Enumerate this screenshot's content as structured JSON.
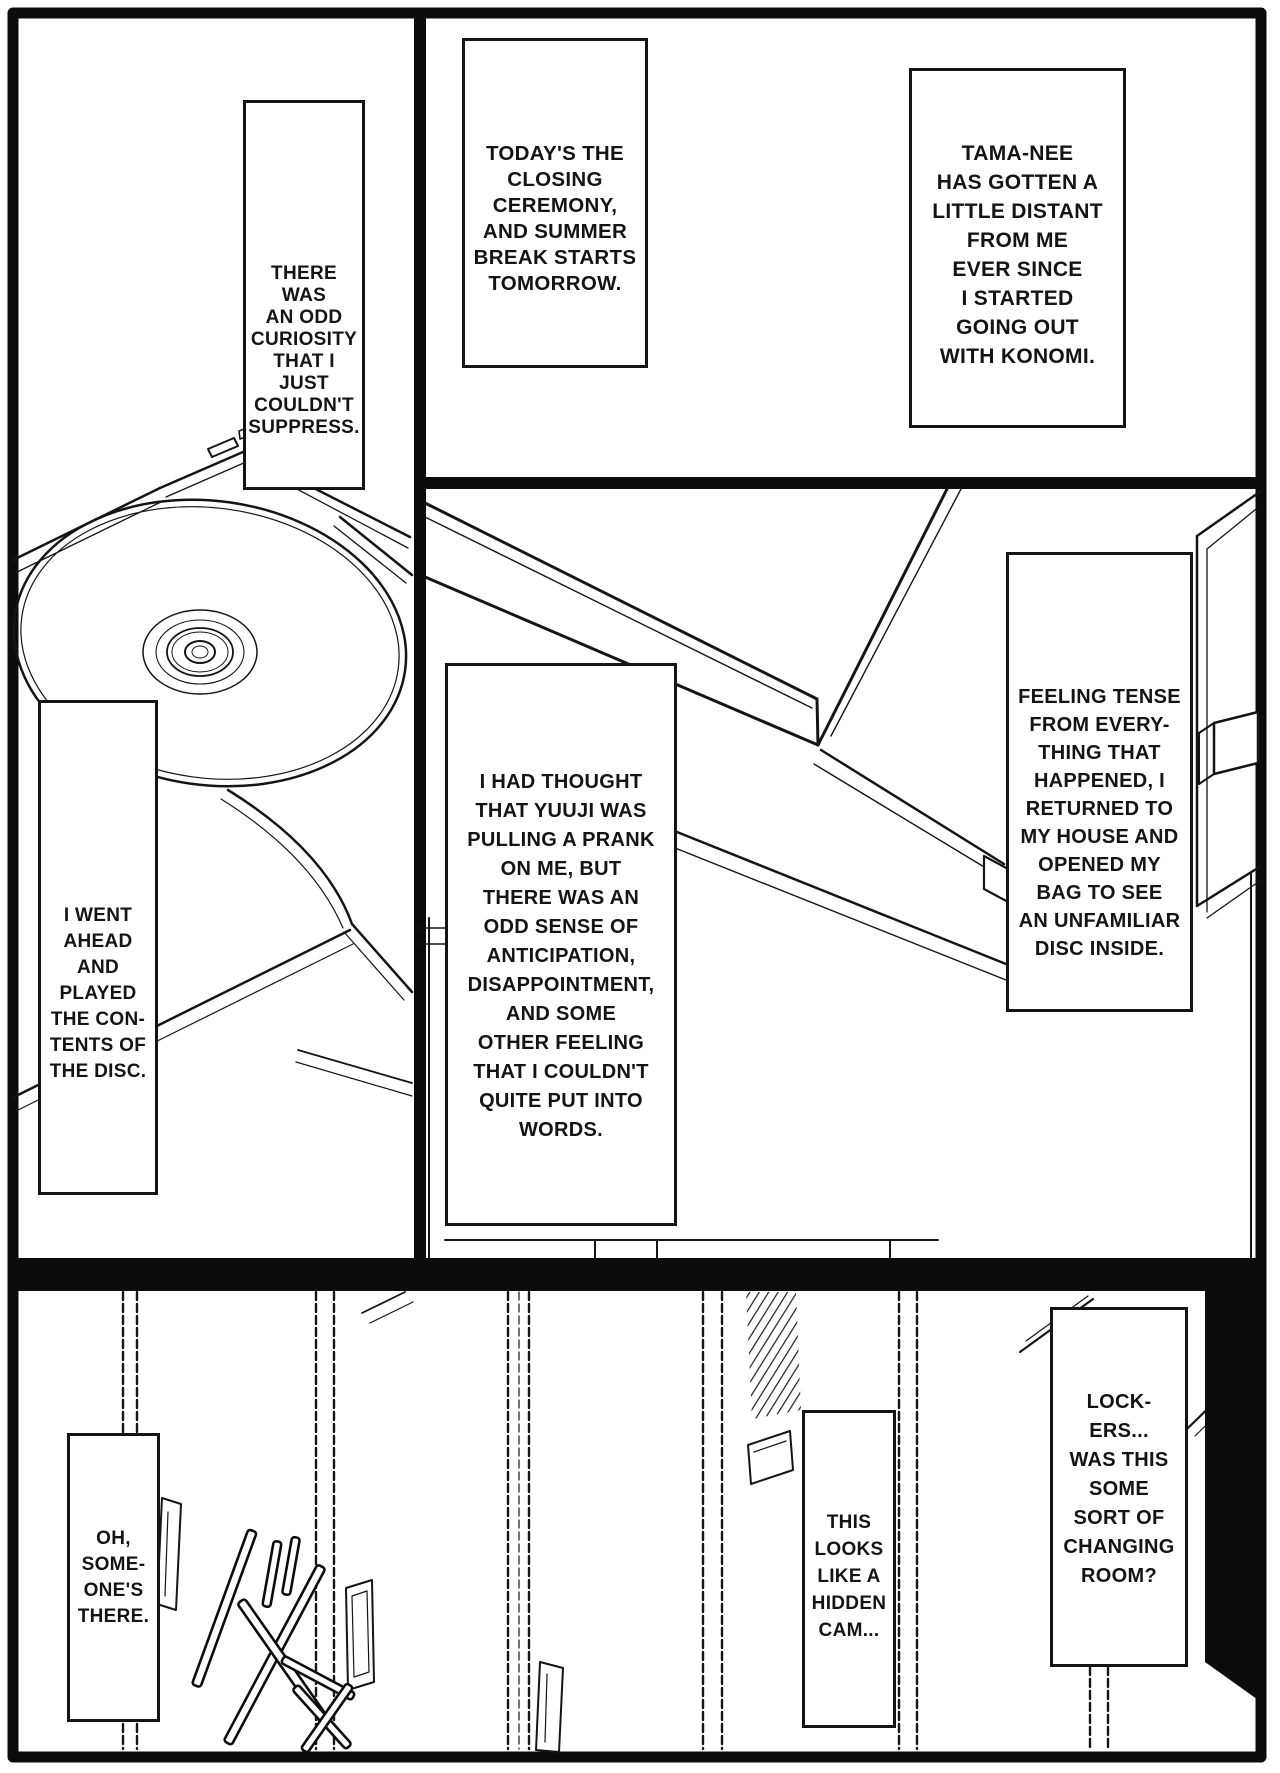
{
  "colors": {
    "ink": "#141414",
    "paper": "#ffffff"
  },
  "captions": [
    {
      "id": "there-was",
      "text": "THERE WAS\nAN ODD\nCURIOSITY\nTHAT I JUST\nCOULDN'T\nSUPPRESS."
    },
    {
      "id": "closing-ceremony",
      "text": "TODAY'S THE\nCLOSING\nCEREMONY,\nAND SUMMER\nBREAK STARTS\nTOMORROW."
    },
    {
      "id": "tama-nee",
      "text": "TAMA-NEE\nHAS GOTTEN A\nLITTLE DISTANT\nFROM ME\nEVER SINCE\nI STARTED\nGOING OUT\nWITH KONOMI."
    },
    {
      "id": "i-went-ahead",
      "text": "I WENT\nAHEAD\nAND\nPLAYED\nTHE CON-\nTENTS OF\nTHE DISC."
    },
    {
      "id": "i-had-thought",
      "text": "I HAD THOUGHT\nTHAT YUUJI WAS\nPULLING A PRANK\nON ME, BUT\nTHERE WAS AN\nODD SENSE OF\nANTICIPATION,\nDISAPPOINTMENT,\nAND SOME\nOTHER FEELING\nTHAT I COULDN'T\nQUITE PUT INTO\nWORDS."
    },
    {
      "id": "feeling-tense",
      "text": "FEELING TENSE\nFROM EVERY-\nTHING THAT\nHAPPENED, I\nRETURNED TO\nMY HOUSE AND\nOPENED MY\nBAG TO SEE\nAN UNFAMILIAR\nDISC INSIDE."
    },
    {
      "id": "oh-someone",
      "text": "OH,\nSOME-\nONE'S\nTHERE."
    },
    {
      "id": "hidden-cam",
      "text": "THIS\nLOOKS\nLIKE A\nHIDDEN\nCAM..."
    },
    {
      "id": "lockers",
      "text": "LOCK-\nERS...\nWAS THIS\nSOME\nSORT OF\nCHANGING\nROOM?"
    }
  ],
  "sfx": {
    "text": "ガチャッ"
  }
}
